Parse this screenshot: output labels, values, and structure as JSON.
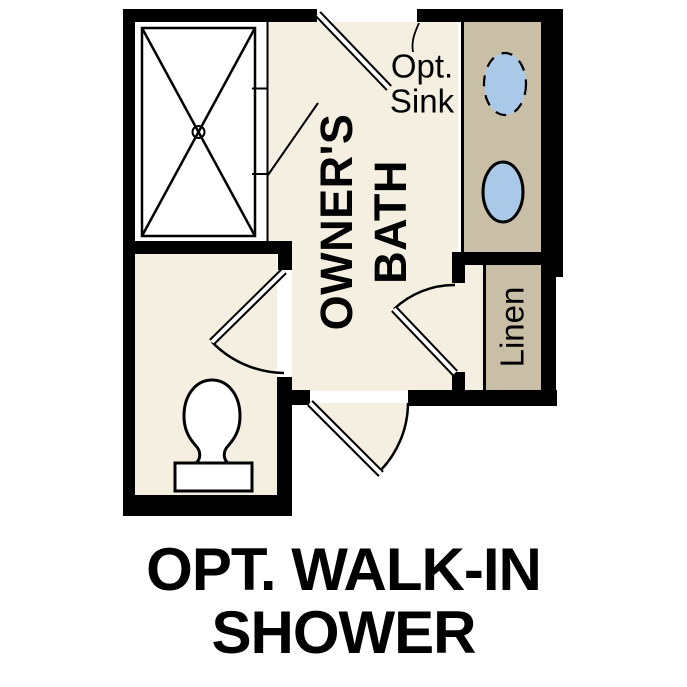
{
  "image_type": "floor-plan",
  "caption": {
    "line1": "OPT. WALK-IN",
    "line2": "SHOWER"
  },
  "labels": {
    "room": {
      "line1": "OWNER'S",
      "line2": "BATH"
    },
    "closet": "Linen",
    "annotation": {
      "line1": "Opt.",
      "line2": "Sink"
    }
  },
  "fixtures": [
    "walk-in-shower",
    "shower-glass-panel",
    "vanity-counter",
    "vanity-sink-optional-dashed",
    "vanity-sink",
    "toilet",
    "linen-closet",
    "door-top-entry",
    "door-toilet-room",
    "door-linen-closet",
    "door-bottom-entry"
  ],
  "colors": {
    "bg": "#ffffff",
    "floor": "#f5efe2",
    "cabinet": "#c9bfa7",
    "fixture-blue": "#aac9e9",
    "wall": "#000000",
    "text": "#000000"
  }
}
